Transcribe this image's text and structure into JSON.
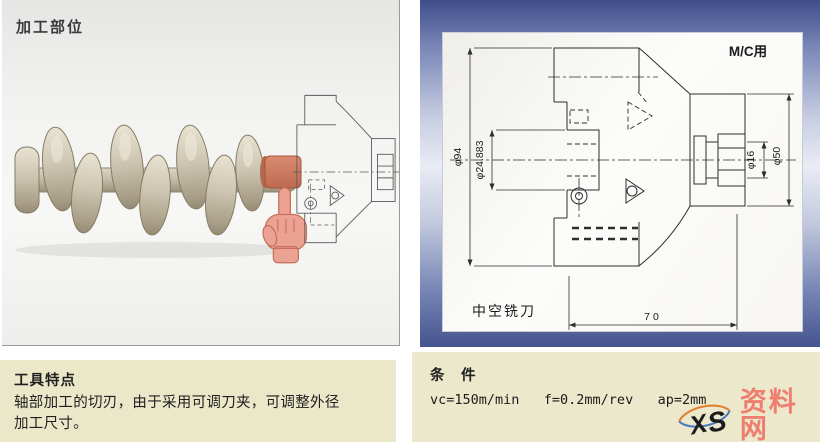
{
  "left_panel": {
    "title": "加工部位"
  },
  "tool_features": {
    "title": "工具特点",
    "line1": "轴部加工的切刃，由于采用可调刀夹，可调整外径",
    "line2": "加工尺寸。"
  },
  "conditions": {
    "title": "条　件",
    "values": "vc=150m/min   f=0.2mm/rev   ap=2mm"
  },
  "drawing": {
    "corner_label": "M/C用",
    "tool_name": "中空铣刀",
    "dim_outer": "φ94",
    "dim_bore": "φ24.883",
    "dim_pilot": "φ16",
    "dim_flange": "φ50",
    "dim_length": "70"
  },
  "icons": {
    "pointer": "hand-pointing-icon",
    "logo": "xs-ellipse-logo"
  },
  "watermark": {
    "initials_x": "X",
    "initials_s": "S",
    "site_name": "资料网",
    "site_url": "ZL.XS1616.COM"
  },
  "colors": {
    "highlight_red": "#cd7a60",
    "hand_pink": "#eca293",
    "frame_blue": "#46548f",
    "note_beige": "#ebe7c9"
  }
}
